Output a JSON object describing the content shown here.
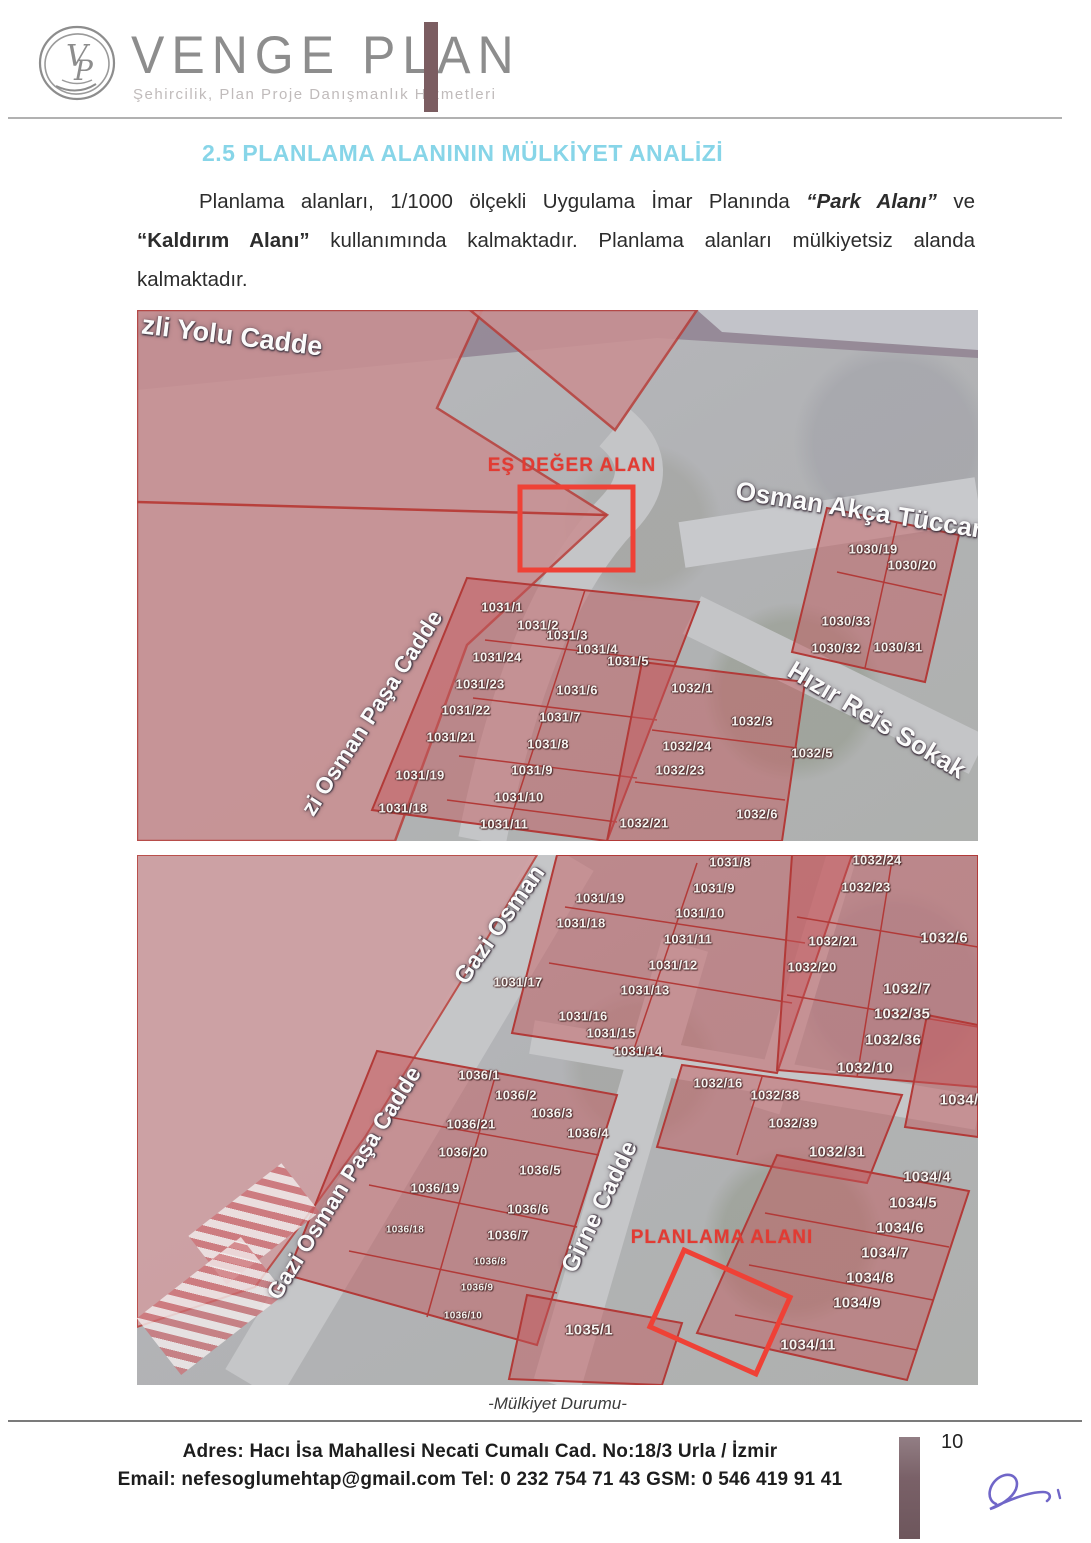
{
  "header": {
    "brand": "VENGE PLAN",
    "monogram": "VP",
    "tagline": "Şehircilik, Plan Proje Danışmanlık Hizmetleri"
  },
  "section": {
    "heading": "2.5 PLANLAMA ALANININ MÜLKİYET ANALİZİ",
    "heading_color": "#87d5e8",
    "paragraph": [
      {
        "t": "Planlama alanları, 1/1000 ölçekli Uygulama İmar Planında ",
        "s": "n"
      },
      {
        "t": "“Park Alanı”",
        "s": "bi"
      },
      {
        "t": " ve ",
        "s": "n"
      },
      {
        "t": "“Kaldırım Alanı”",
        "s": "b"
      },
      {
        "t": " kullanımında kalmaktadır. Planlama alanları mülkiyetsiz alanda kalmaktadır.",
        "s": "n"
      }
    ]
  },
  "map1": {
    "annotation": "EŞ DEĞER ALAN",
    "annotation_color": "#e23b33",
    "street_labels": [
      {
        "text": "zli Yolu Cadde",
        "x": 95,
        "y": 26,
        "rot": 7,
        "size": 27
      },
      {
        "text": "Osman Akça Tüccar",
        "x": 722,
        "y": 200,
        "rot": 9,
        "size": 26
      },
      {
        "text": "Hızır Reis Sokak",
        "x": 740,
        "y": 410,
        "rot": 31,
        "size": 26
      },
      {
        "text": "zi Osman Paşa Cadde",
        "x": 235,
        "y": 403,
        "rot": -57,
        "size": 23
      }
    ],
    "parcels": [
      [
        "1030/19",
        736,
        239
      ],
      [
        "1030/20",
        775,
        255
      ],
      [
        "1030/33",
        709,
        311
      ],
      [
        "1030/32",
        699,
        338
      ],
      [
        "1030/31",
        761,
        337
      ],
      [
        "1031/1",
        365,
        297
      ],
      [
        "1031/2",
        401,
        315
      ],
      [
        "1031/3",
        430,
        325
      ],
      [
        "1031/4",
        460,
        339
      ],
      [
        "1031/24",
        360,
        347
      ],
      [
        "1031/5",
        491,
        351
      ],
      [
        "1031/23",
        343,
        374
      ],
      [
        "1031/6",
        440,
        380
      ],
      [
        "1031/22",
        329,
        400
      ],
      [
        "1031/7",
        423,
        407
      ],
      [
        "1031/21",
        314,
        427
      ],
      [
        "1031/8",
        411,
        434
      ],
      [
        "1031/9",
        395,
        460
      ],
      [
        "1031/19",
        283,
        465
      ],
      [
        "1031/10",
        382,
        487
      ],
      [
        "1031/18",
        266,
        498
      ],
      [
        "1031/11",
        367,
        514
      ],
      [
        "1032/1",
        555,
        378
      ],
      [
        "1032/3",
        615,
        411
      ],
      [
        "1032/24",
        550,
        436
      ],
      [
        "1032/5",
        675,
        443
      ],
      [
        "1032/23",
        543,
        460
      ],
      [
        "1032/21",
        507,
        513
      ],
      [
        "1032/6",
        620,
        504
      ]
    ]
  },
  "map2": {
    "annotation": "PLANLAMA ALANI",
    "annotation_color": "#e23b33",
    "street_labels": [
      {
        "text": "Gazi Osman",
        "x": 363,
        "y": 70,
        "rot": -55,
        "size": 24
      },
      {
        "text": "Gazi Osman Paşa Cadde",
        "x": 207,
        "y": 328,
        "rot": -58,
        "size": 23
      },
      {
        "text": "Girne Cadde",
        "x": 463,
        "y": 352,
        "rot": -64,
        "size": 24
      }
    ],
    "parcels": [
      [
        "1031/8",
        593,
        7
      ],
      [
        "1032/24",
        740,
        5
      ],
      [
        "1031/9",
        577,
        33
      ],
      [
        "1032/23",
        729,
        32
      ],
      [
        "1031/19",
        463,
        43
      ],
      [
        "1031/10",
        563,
        58
      ],
      [
        "1031/18",
        444,
        68
      ],
      [
        "1031/11",
        551,
        84
      ],
      [
        "1032/21",
        696,
        86
      ],
      [
        "1032/6",
        807,
        83,
        "l"
      ],
      [
        "1031/12",
        536,
        110
      ],
      [
        "1032/20",
        675,
        112
      ],
      [
        "1031/17",
        381,
        127
      ],
      [
        "1031/13",
        508,
        135
      ],
      [
        "1032/7",
        770,
        134,
        "l"
      ],
      [
        "1031/16",
        446,
        161
      ],
      [
        "1032/35",
        765,
        159,
        "l"
      ],
      [
        "1031/15",
        474,
        178
      ],
      [
        "1032/36",
        756,
        185,
        "l"
      ],
      [
        "1031/14",
        501,
        196
      ],
      [
        "1032/10",
        728,
        213,
        "l"
      ],
      [
        "1036/1",
        342,
        220
      ],
      [
        "1032/16",
        581,
        228
      ],
      [
        "1032/38",
        638,
        240
      ],
      [
        "1036/2",
        379,
        240
      ],
      [
        "1036/3",
        415,
        258
      ],
      [
        "1036/21",
        334,
        269
      ],
      [
        "1032/39",
        656,
        268
      ],
      [
        "1036/4",
        451,
        278
      ],
      [
        "1034/",
        822,
        245,
        "l"
      ],
      [
        "1036/20",
        326,
        297
      ],
      [
        "1032/31",
        700,
        297,
        "l"
      ],
      [
        "1036/5",
        403,
        315
      ],
      [
        "1036/19",
        298,
        333
      ],
      [
        "1034/4",
        790,
        322,
        "l"
      ],
      [
        "1034/5",
        776,
        348,
        "l"
      ],
      [
        "1034/6",
        763,
        373,
        "l"
      ],
      [
        "1036/6",
        391,
        354
      ],
      [
        "1036/18",
        268,
        375,
        "s"
      ],
      [
        "1036/7",
        371,
        380
      ],
      [
        "1034/7",
        748,
        398,
        "l"
      ],
      [
        "1036/8",
        353,
        407,
        "s"
      ],
      [
        "1034/8",
        733,
        423,
        "l"
      ],
      [
        "1036/9",
        340,
        433,
        "s"
      ],
      [
        "1034/9",
        720,
        448,
        "l"
      ],
      [
        "1036/10",
        326,
        461,
        "s"
      ],
      [
        "1035/1",
        452,
        475,
        "l"
      ],
      [
        "1034/11",
        671,
        490,
        "l"
      ]
    ]
  },
  "caption": "-Mülkiyet Durumu-",
  "footer": {
    "address": "Adres: Hacı İsa Mahallesi Necati Cumalı  Cad. No:18/3  Urla / İzmir",
    "contact": "Email: nefesoglumehtap@gmail.com  Tel: 0 232 754 71 43   GSM: 0 546 419 91 41",
    "page_number": "10"
  }
}
